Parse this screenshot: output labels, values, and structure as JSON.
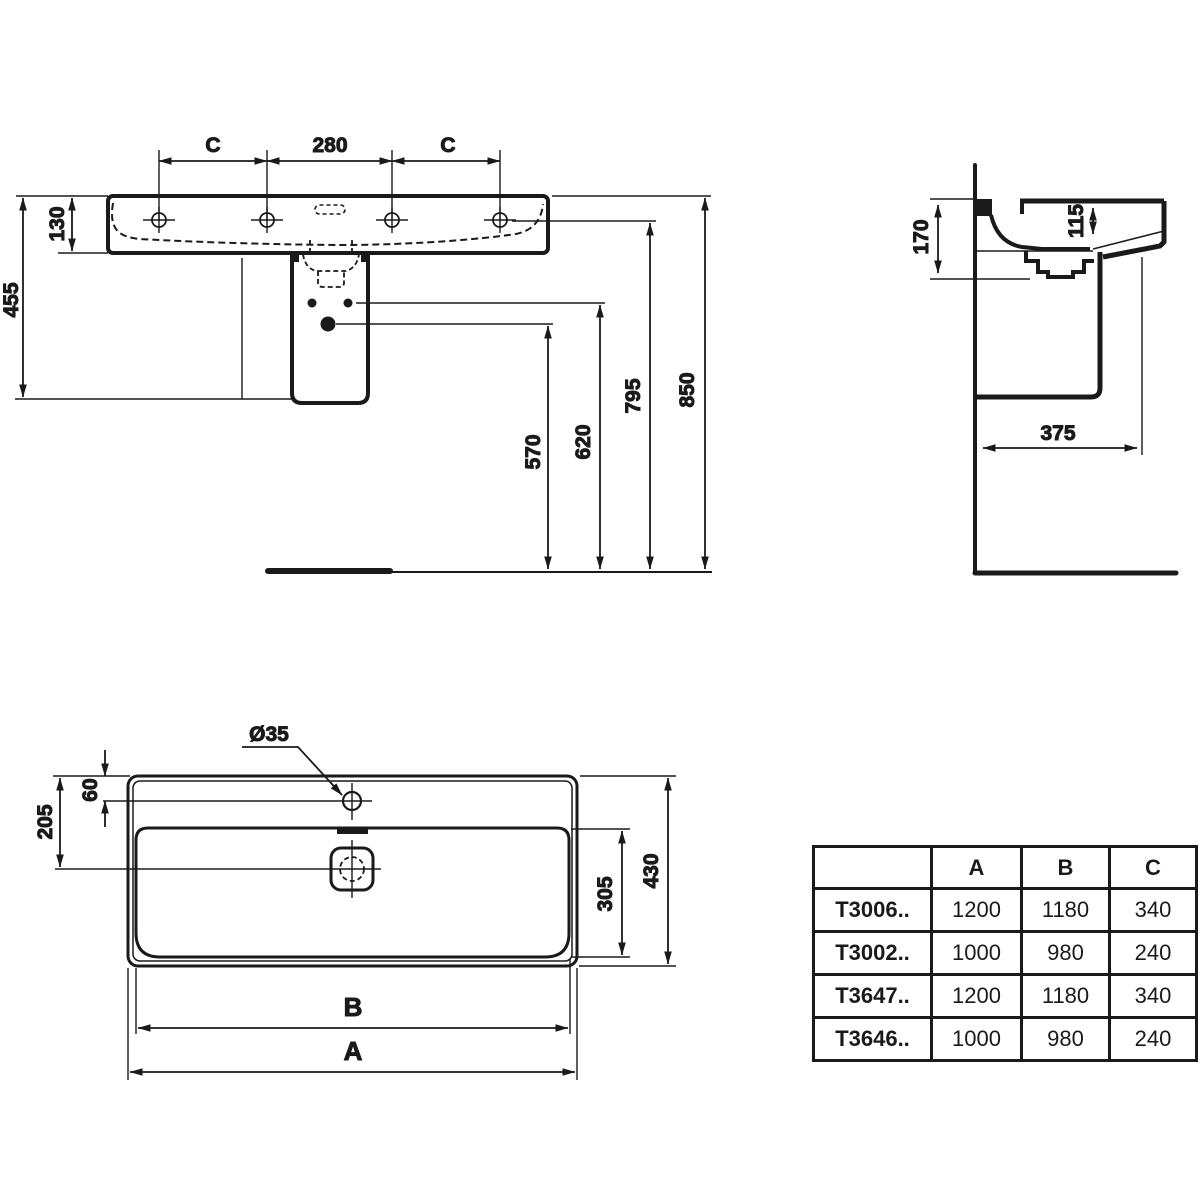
{
  "front": {
    "c_left": "C",
    "hole_spacing": "280",
    "c_right": "C",
    "rim_height": "130",
    "pedestal_height": "455",
    "trap_outlet_height": "570",
    "supply_height": "620",
    "rim_top_height": "795",
    "overall_height": "850"
  },
  "side": {
    "front_depth": "170",
    "bowl_depth": "115",
    "projection": "375"
  },
  "plan": {
    "hole_dia": "Ø35",
    "hole_offset": "60",
    "drain_offset": "205",
    "bowl_depth": "305",
    "overall_depth": "430",
    "inner_width": "B",
    "outer_width": "A"
  },
  "table": {
    "headers": [
      "",
      "A",
      "B",
      "C"
    ],
    "rows": [
      {
        "code": "T3006..",
        "a": "1200",
        "b": "1180",
        "c": "340"
      },
      {
        "code": "T3002..",
        "a": "1000",
        "b": "980",
        "c": "240"
      },
      {
        "code": "T3647..",
        "a": "1200",
        "b": "1180",
        "c": "340"
      },
      {
        "code": "T3646..",
        "a": "1000",
        "b": "980",
        "c": "240"
      }
    ]
  },
  "colors": {
    "line": "#1a1a1a",
    "bg": "#ffffff"
  }
}
